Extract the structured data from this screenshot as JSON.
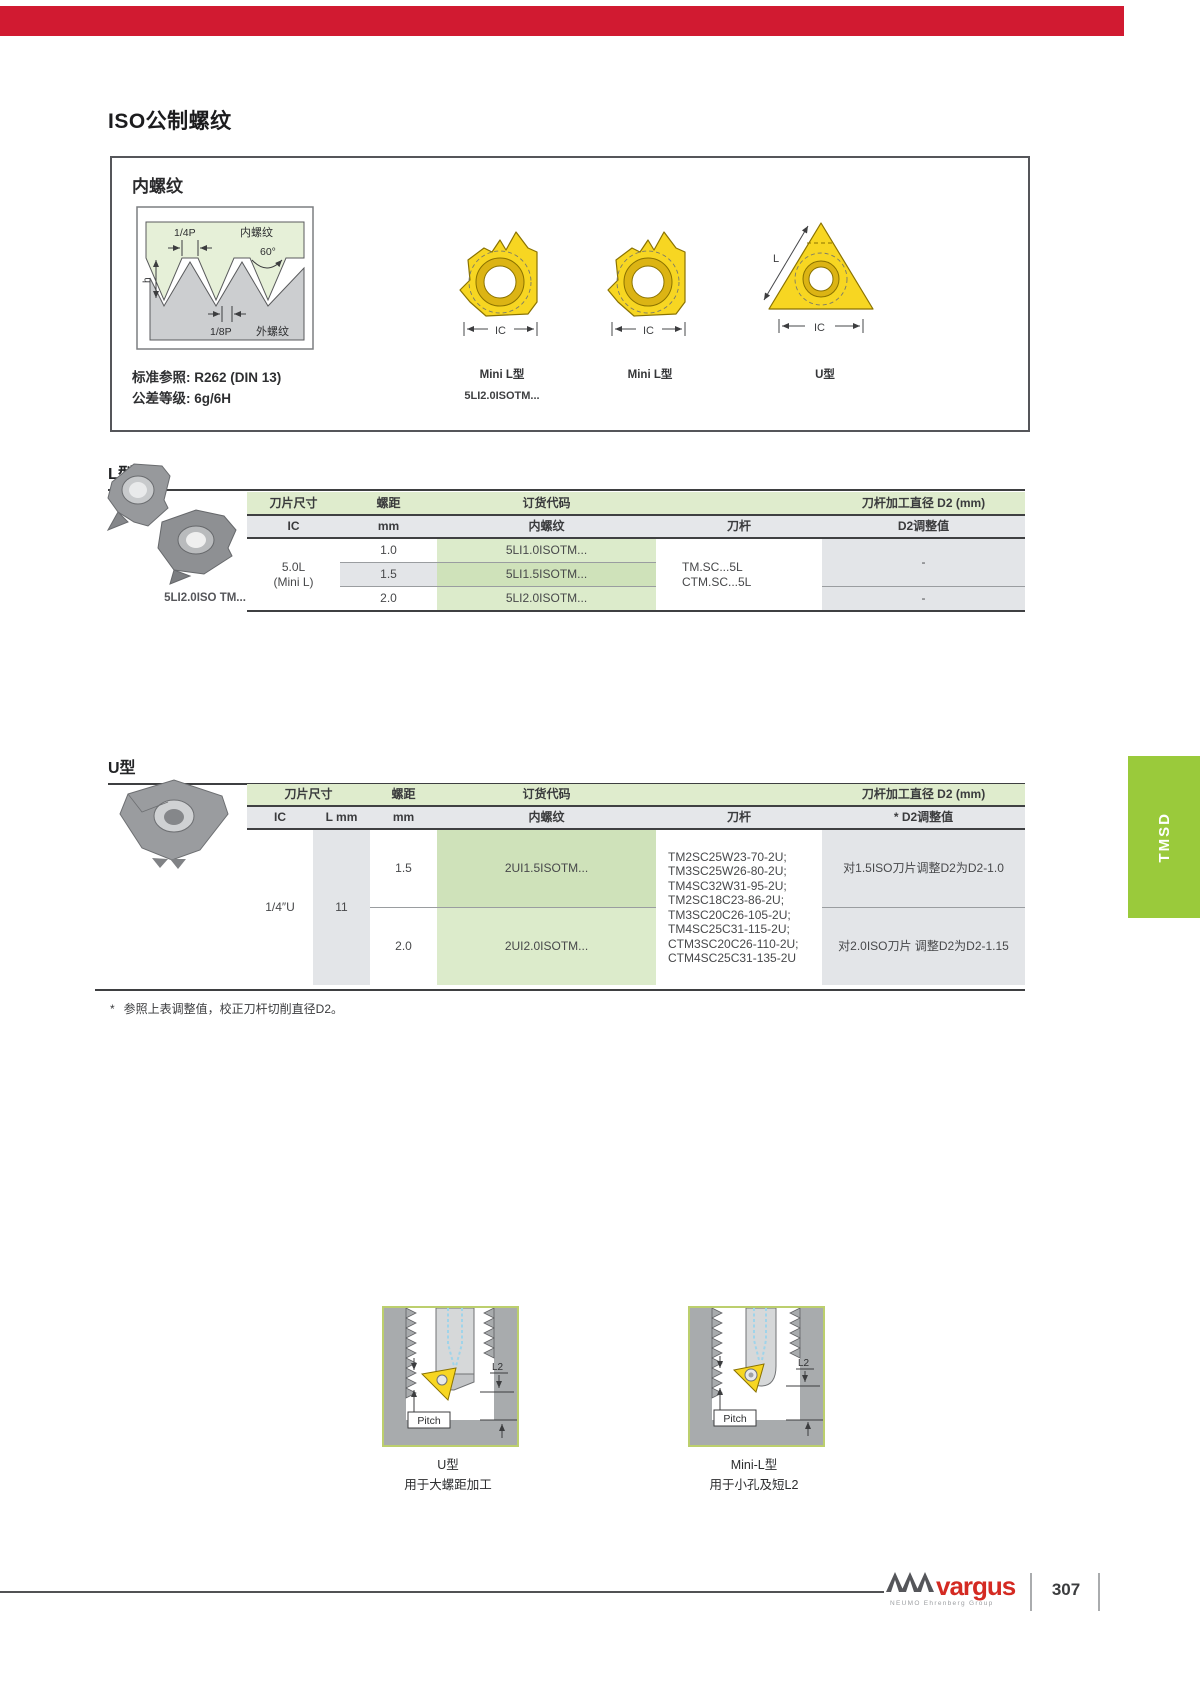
{
  "title": "ISO公制螺纹",
  "colors": {
    "topbar_red": "#d11a31",
    "tab_green": "#9aca3b",
    "table_header_green": "#dfeccd",
    "code_cell_green": "#dcebcb",
    "insert_yellow": "#f7d622",
    "logo_red": "#d42a22"
  },
  "intro": {
    "heading": "内螺纹",
    "standard_ref": "标准参照: R262 (DIN 13)",
    "tolerance": "公差等级: 6g/6H",
    "diagram_labels": {
      "quarter_pitch": "1/4P",
      "internal_thread": "内螺纹",
      "angle": "60°",
      "height": "h",
      "eighth_pitch": "1/8P",
      "external_thread": "外螺纹"
    },
    "inserts": [
      {
        "caption": "Mini L型",
        "code": "5LI2.0ISOTM...",
        "ic_label": "IC"
      },
      {
        "caption": "Mini L型",
        "ic_label": "IC"
      },
      {
        "caption": "U型",
        "ic_label": "IC",
        "l_label": "L"
      }
    ]
  },
  "l_section": {
    "heading": "L型",
    "photo_caption": "5LI2.0ISO TM...",
    "col_headers": {
      "insert_size": "刀片尺寸",
      "pitch": "螺距",
      "order_code": "订货代码",
      "shank_d2": "刀杆加工直径 D2 (mm)"
    },
    "sub_headers": {
      "ic": "IC",
      "mm": "mm",
      "internal_thread": "内螺纹",
      "shank": "刀杆",
      "d2_adjust": "D2调整值"
    },
    "insert_size": "5.0L",
    "insert_size_note": "(Mini L)",
    "rows": [
      {
        "pitch": "1.0",
        "code": "5LI1.0ISOTM..."
      },
      {
        "pitch": "1.5",
        "code": "5LI1.5ISOTM..."
      },
      {
        "pitch": "2.0",
        "code": "5LI2.0ISOTM..."
      }
    ],
    "shank_line1": "TM.SC...5L",
    "shank_line2": "CTM.SC...5L",
    "d2_group1": "-",
    "d2_group2": "-"
  },
  "u_section": {
    "heading": "U型",
    "col_headers": {
      "insert_size": "刀片尺寸",
      "pitch": "螺距",
      "order_code": "订货代码",
      "shank_d2": "刀杆加工直径 D2 (mm)"
    },
    "sub_headers": {
      "ic": "IC",
      "l": "L mm",
      "mm": "mm",
      "internal_thread": "内螺纹",
      "shank": "刀杆",
      "d2_adjust": "* D2调整值"
    },
    "ic_value": "1/4″U",
    "l_value": "11",
    "rows": [
      {
        "pitch": "1.5",
        "code": "2UI1.5ISOTM...",
        "d2_adjust": "对1.5ISO刀片调整D2为D2-1.0"
      },
      {
        "pitch": "2.0",
        "code": "2UI2.0ISOTM...",
        "d2_adjust": "对2.0ISO刀片 调整D2为D2-1.15"
      }
    ],
    "shank_codes": [
      "TM2SC25W23-70-2U;",
      "TM3SC25W26-80-2U;",
      "TM4SC32W31-95-2U;",
      "TM2SC18C23-86-2U;",
      "TM3SC20C26-105-2U;",
      "TM4SC25C31-115-2U;",
      "CTM3SC20C26-110-2U;",
      "CTM4SC25C31-135-2U"
    ]
  },
  "footnote_mark": "*",
  "footnote": "参照上表调整值，校正刀杆切削直径D2。",
  "figures": [
    {
      "name": "U型",
      "desc": "用于大螺距加工",
      "pitch_label": "Pitch",
      "l2_label": "L2"
    },
    {
      "name": "Mini-L型",
      "desc": "用于小孔及短L2",
      "pitch_label": "Pitch",
      "l2_label": "L2"
    }
  ],
  "side_tab": "TMSD",
  "footer": {
    "brand": "vargus",
    "brand_subtitle": "NEUMO Ehrenberg Group",
    "page_number": "307"
  }
}
